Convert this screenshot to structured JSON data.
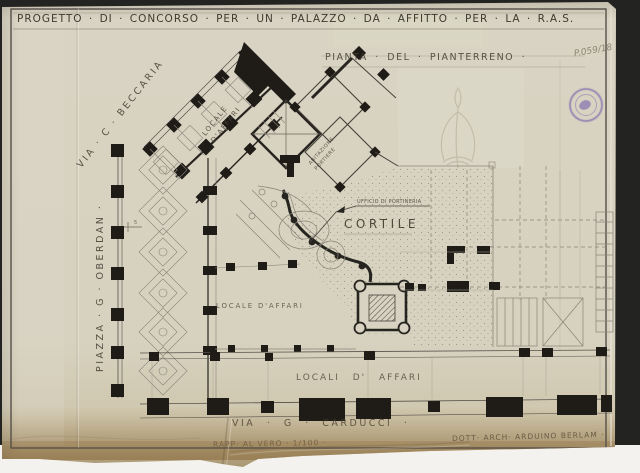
{
  "document": {
    "title": "PROGETTO · DI · CONCORSO · PER · UN · PALAZZO · DA · AFFITTO · PER · LA · R.A.S.",
    "subtitle": "PIANTA · DEL · PIANTERRENO ·",
    "archive_number": "P.059/18",
    "scale_note": "RAPP· AL VERO · 1/100 ·",
    "credit": "DOTT· ARCH· ARDUINO BERLAM ·"
  },
  "plan_labels": {
    "street_top_left": "VIA · C · BECCARIA",
    "street_left": "PIAZZA · G · OBERDAN ·",
    "street_bottom": "VIA · G · CARDUCCI ·",
    "courtyard": "CORTILE",
    "porter_office": "UFFICIO DI PORTINERIA",
    "porter_flat_line1": "ABITAZIONE",
    "porter_flat_line2": "PORTIERE",
    "shop_diagonal_line1": "LOCALE",
    "shop_diagonal_line2": "D'AFFARI",
    "shop_left": "LOCALE D'AFFARI",
    "shops_bottom": "LOCALI  D' AFFARI",
    "dimension_note": "5"
  },
  "stamp": {
    "kind": "round-ink-stamp",
    "color": "#7d6fb0"
  },
  "colors": {
    "paper": "#d8d3c2",
    "ink": "#242118",
    "pencil": "#8a8478",
    "stain": "#b39a70",
    "scan_background": "#232322",
    "scanner_bed": "#f3f2ee"
  }
}
